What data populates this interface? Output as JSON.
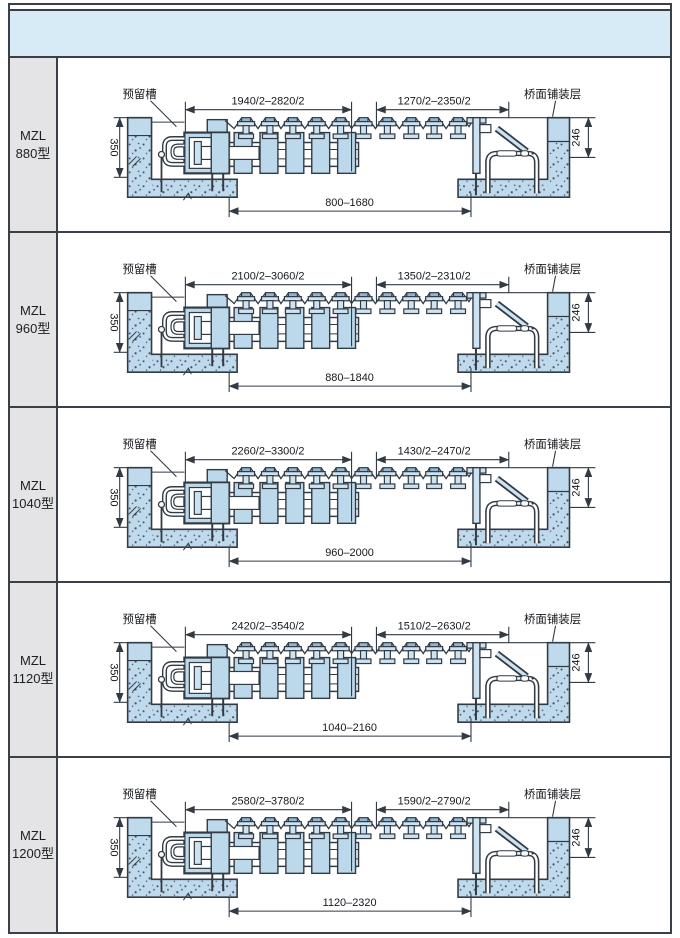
{
  "header": {
    "note": ""
  },
  "labels": {
    "groove": "预留槽",
    "pavement": "桥面铺装层",
    "wall_height": "350",
    "pavement_thickness": "246",
    "model_prefix": "MZL"
  },
  "colors": {
    "header_band": "#d7ebf7",
    "label_cell": "#e4e4e7",
    "concrete_fill": "#bfdaec",
    "steel_fill": "#cde3f2",
    "beam_cap": "#8fb6d2",
    "line_dark": "#323a44",
    "frame_border": "#3a4048"
  },
  "table": {
    "rows": [
      {
        "model": "880型",
        "dim_top_left": "1940/2–2820/2",
        "dim_top_right": "1270/2–2350/2",
        "dim_bottom": "800–1680"
      },
      {
        "model": "960型",
        "dim_top_left": "2100/2–3060/2",
        "dim_top_right": "1350/2–2310/2",
        "dim_bottom": "880–1840"
      },
      {
        "model": "1040型",
        "dim_top_left": "2260/2–3300/2",
        "dim_top_right": "1430/2–2470/2",
        "dim_bottom": "960–2000"
      },
      {
        "model": "1120型",
        "dim_top_left": "2420/2–3540/2",
        "dim_top_right": "1510/2–2630/2",
        "dim_bottom": "1040–2160"
      },
      {
        "model": "1200型",
        "dim_top_left": "2580/2–3780/2",
        "dim_top_right": "1590/2–2790/2",
        "dim_bottom": "1120–2320"
      }
    ]
  }
}
